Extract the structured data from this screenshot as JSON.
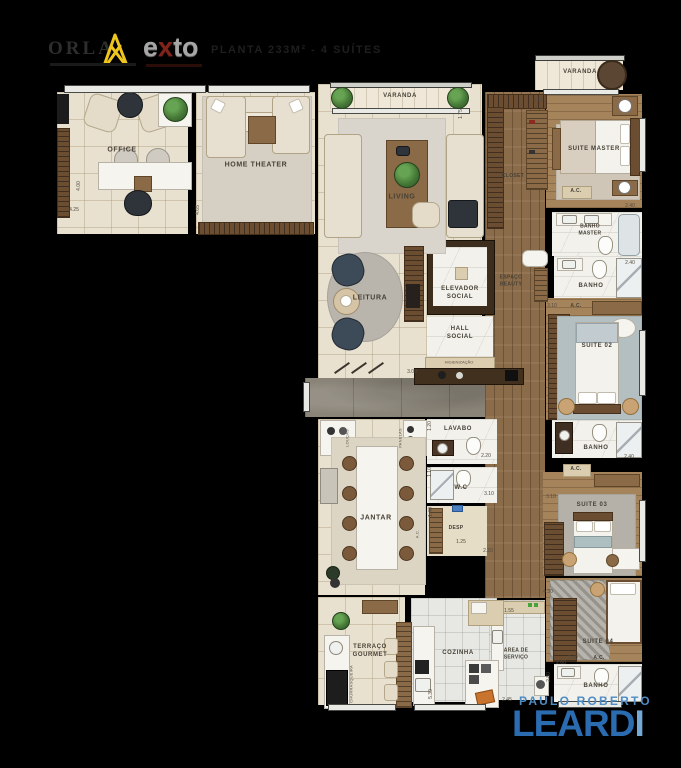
{
  "header": {
    "brand": "ORLA",
    "exto_pre": "e",
    "exto_x": "x",
    "exto_post": "to",
    "title": "PLANTA 233M² - 4 SUÍTES"
  },
  "watermark": {
    "line1": "PAULO ROBERTO",
    "leardi_main": "LEARD",
    "leardi_accent": "I"
  },
  "rooms": {
    "office": "OFFICE",
    "home_theater": "HOME THEATER",
    "varanda_living": "VARANDA",
    "living": "LIVING",
    "leitura": "LEITURA",
    "elevador": "ELEVADOR SOCIAL",
    "hall": "HALL SOCIAL",
    "higienizacao": "HIGIENIZAÇÃO",
    "varanda_suite": "VARANDA",
    "closet": "CLOSET",
    "suite_master": "SUITE MASTER",
    "banho_master": "BANHO MASTER",
    "espaco_beauty": "ESPAÇO BEAUTY",
    "banho": "BANHO",
    "suite_02": "SUITE 02",
    "suite_03": "SUITE 03",
    "suite_04": "SUITE 04",
    "lavabo": "LAVABO",
    "wc": "W.C",
    "desp": "DESP",
    "jantar": "JANTAR",
    "terraco": "TERRAÇO GOURMET",
    "cozinha": "COZINHA",
    "area_servico": "AREA DE SERVIÇO",
    "ac": "A.C.",
    "loucas": "LOUÇAS",
    "panelas": "PANELAS",
    "churrasqueira": "CHURRASQUEIRA"
  },
  "dims": {
    "office_w": "4.25",
    "office_h": "4.00",
    "ht_h": "4.65",
    "varanda": "1.75",
    "closet": "4.85",
    "banho_master": "2.40",
    "banho_2": "2.40",
    "suite_02": "3.10",
    "hall": "3.00",
    "lavabo_h": "1.20",
    "lavabo_w": "2.20",
    "wc_h": "1.10",
    "wc_w": "3.10",
    "desp_h": "1.40",
    "desp_w": "1.25",
    "svc": "2.20",
    "banho_3": "2.40",
    "suite_03_w": "3.10",
    "suite_03_h": "4.30",
    "suite_04": "2.40",
    "banho_4_w": "2.60",
    "banho_4_h": "2.80",
    "area_w": "1.55",
    "area_b": "2.45",
    "cozinha": "5.30"
  }
}
